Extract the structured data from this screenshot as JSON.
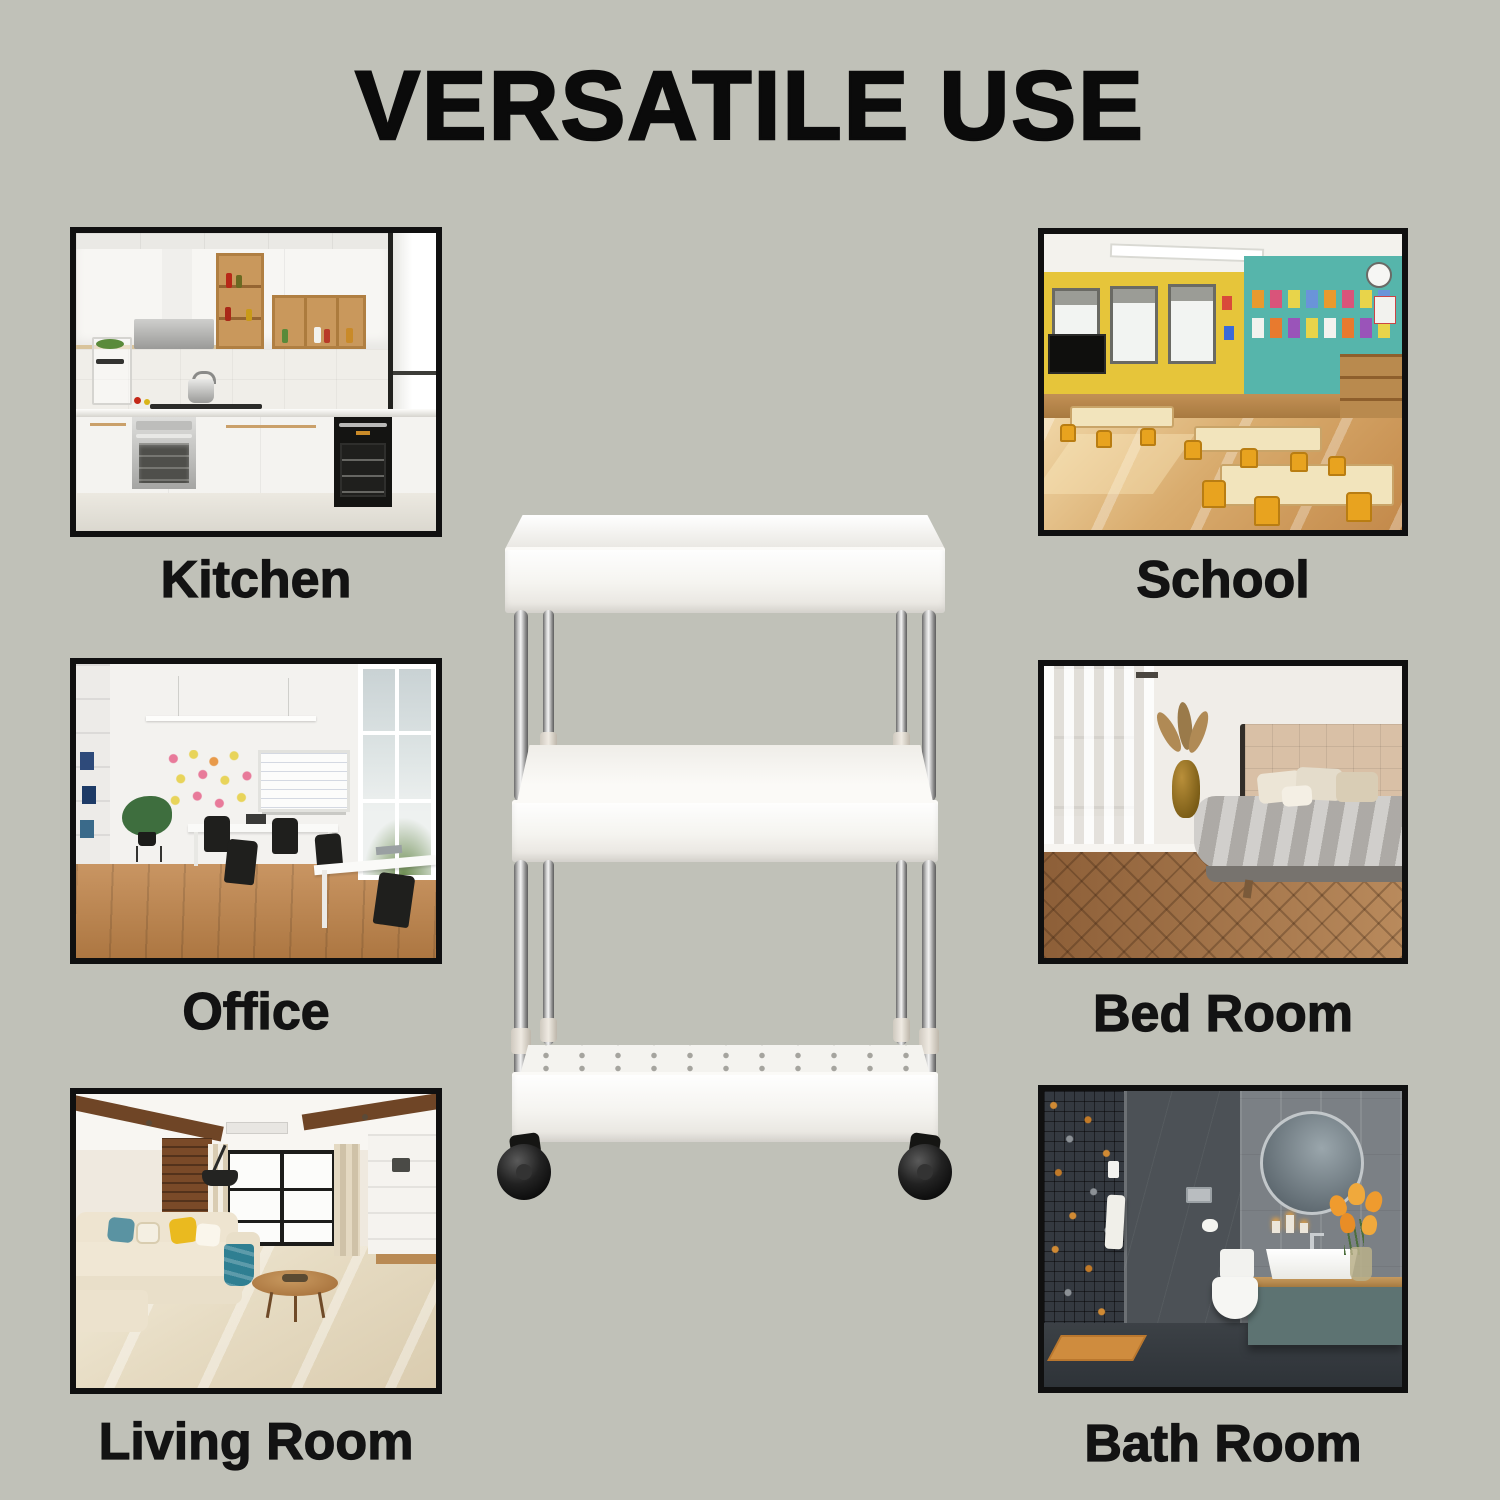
{
  "title": "VERSATILE USE",
  "colors": {
    "background": "#c0c1b8",
    "heading_text": "#0b0b0b",
    "label_text": "#131313",
    "photo_border": "#101010",
    "cart_white": "#f6f5f1",
    "cart_chrome": "#bfbfbf",
    "caster_black": "#141414",
    "school_accent_teal": "#56b5ab",
    "school_accent_yellow": "#e6c53a",
    "bathroom_accent_orange": "#d08a34"
  },
  "rooms": [
    {
      "id": "kitchen",
      "label": "Kitchen",
      "photo_alt": "Modern white kitchen with wood open shelves, silver and black built-in ovens and a bright window"
    },
    {
      "id": "school",
      "label": "School",
      "photo_alt": "Classroom with yellow tables and chairs, yellow window wall, teal display wall and glossy floor"
    },
    {
      "id": "office",
      "label": "Office",
      "photo_alt": "White open-plan office with wooden floor, white desks, black chairs, whiteboard and tall windows"
    },
    {
      "id": "bed-room",
      "label": "Bed Room",
      "photo_alt": "Bedroom with tufted beige headboard, gray bedding, sheer curtains, amber vase and herringbone wood floor"
    },
    {
      "id": "living-room",
      "label": "Living Room",
      "photo_alt": "Living room with cream sectional sofa, yellow and teal cushions, round wooden coffee table and large window"
    },
    {
      "id": "bath-room",
      "label": "Bath Room",
      "photo_alt": "Dark gray bathroom with mosaic shower wall, round mirror, white basin on wooden counter, orange tulips and orange mat"
    }
  ],
  "product": {
    "tiers": 3,
    "photo_alt": "White 3-tier slim rolling storage cart with chrome poles, perforated bottom basket and black swivel caster wheels"
  }
}
